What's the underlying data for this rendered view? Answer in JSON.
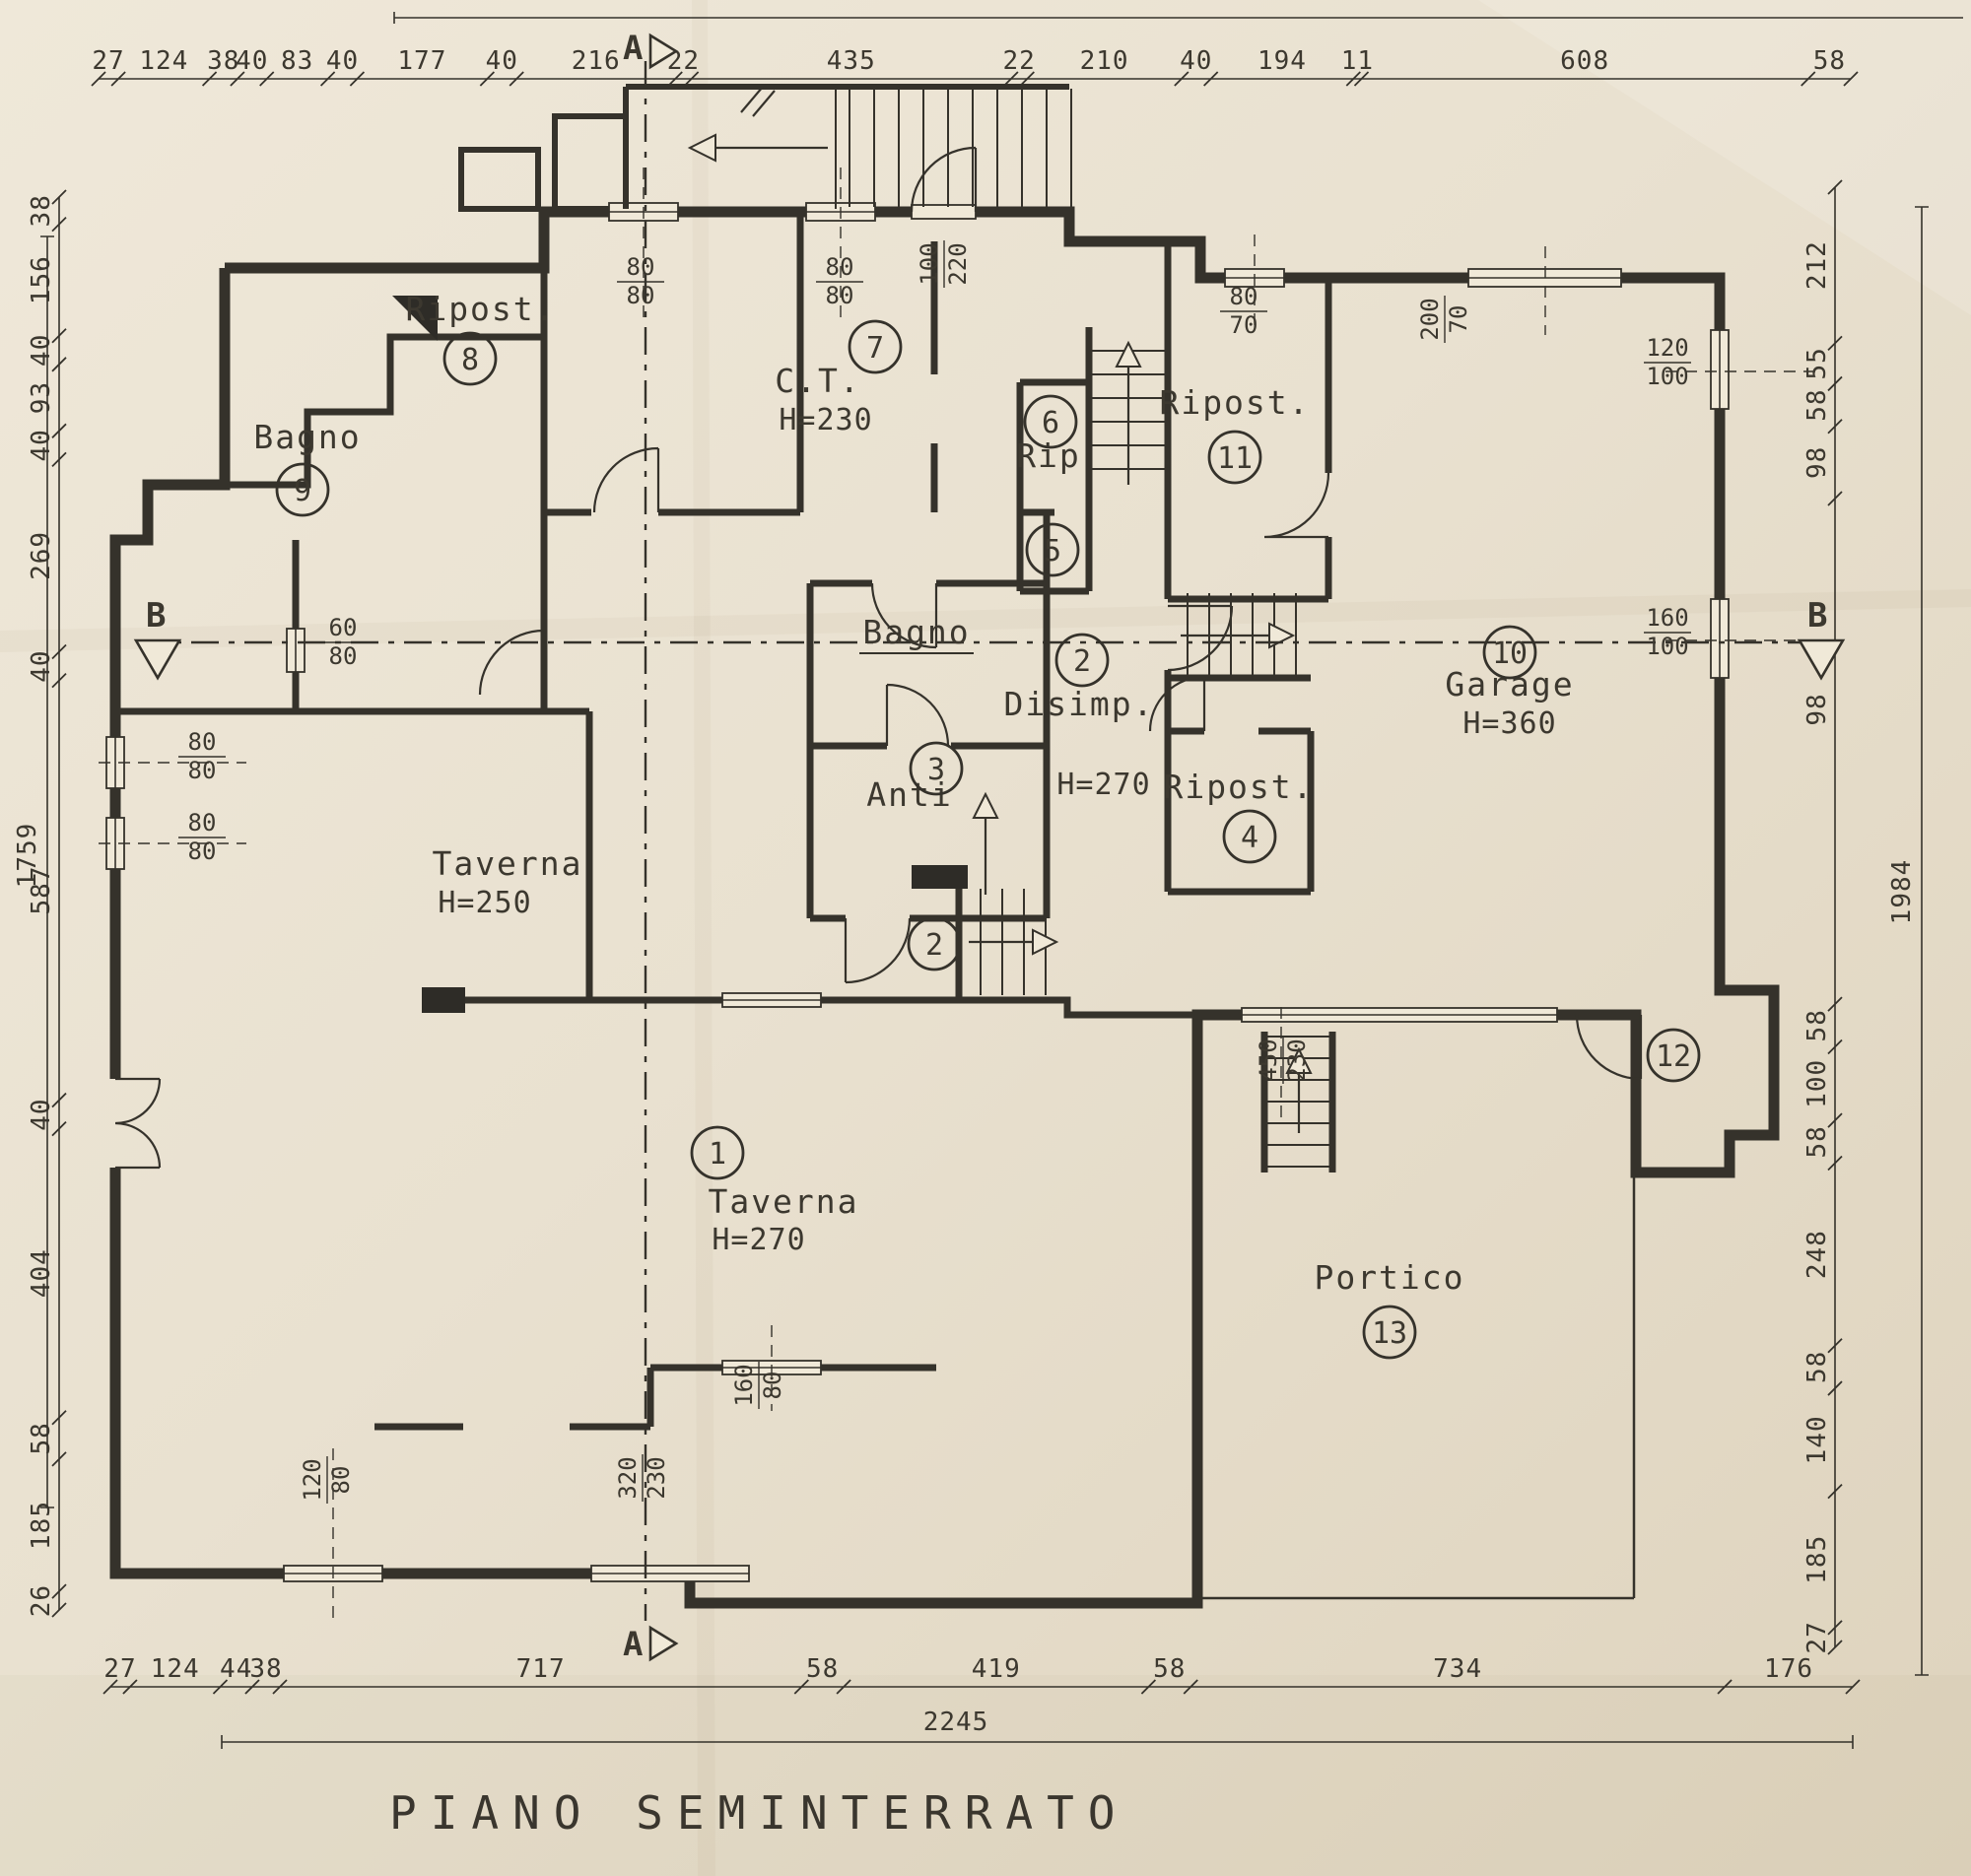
{
  "title": "PIANO SEMINTERRATO",
  "sections": {
    "a": "A",
    "b": "B"
  },
  "rooms": [
    {
      "id": "taverna-1",
      "label": "Taverna",
      "height": "H=270",
      "number": "1"
    },
    {
      "id": "taverna-250",
      "label": "Taverna",
      "height": "H=250",
      "number": ""
    },
    {
      "id": "disimp-2",
      "label": "Disimp.",
      "height": "H=270",
      "number": "2"
    },
    {
      "id": "anti-3",
      "label": "Anti",
      "height": "",
      "number": "3"
    },
    {
      "id": "ripost-4",
      "label": "Ripost.",
      "height": "",
      "number": "4"
    },
    {
      "id": "vano-5",
      "label": "",
      "height": "",
      "number": "5"
    },
    {
      "id": "rip-6",
      "label": "Rip",
      "height": "",
      "number": "6"
    },
    {
      "id": "ct-7",
      "label": "C.T.",
      "height": "H=230",
      "number": "7"
    },
    {
      "id": "ripost-8",
      "label": "Ripost.",
      "height": "",
      "number": "8"
    },
    {
      "id": "bagno-9",
      "label": "Bagno",
      "height": "",
      "number": "9"
    },
    {
      "id": "garage-10",
      "label": "Garage",
      "height": "H=360",
      "number": "10"
    },
    {
      "id": "ripost-11",
      "label": "Ripost.",
      "height": "",
      "number": "11"
    },
    {
      "id": "ingresso-12",
      "label": "",
      "height": "",
      "number": "12"
    },
    {
      "id": "portico-13",
      "label": "Portico",
      "height": "",
      "number": "13"
    },
    {
      "id": "bagno-centrale",
      "label": "Bagno",
      "height": "",
      "number": "",
      "underline": true
    },
    {
      "id": "scala-2",
      "label": "",
      "height": "",
      "number": "2"
    }
  ],
  "openings": [
    {
      "id": "ct-window-left",
      "num": "80",
      "den": "80"
    },
    {
      "id": "ct-window-right",
      "num": "80",
      "den": "80"
    },
    {
      "id": "hall-top-door",
      "num": "100",
      "den": "220"
    },
    {
      "id": "ripost11-window",
      "num": "80",
      "den": "70"
    },
    {
      "id": "garage-top-window",
      "num": "200",
      "den": "70"
    },
    {
      "id": "garage-right-window-upper",
      "num": "120",
      "den": "100"
    },
    {
      "id": "garage-right-window-lower",
      "num": "160",
      "den": "100"
    },
    {
      "id": "bagno9-window",
      "num": "60",
      "den": "80"
    },
    {
      "id": "taverna250-window-upper",
      "num": "80",
      "den": "80"
    },
    {
      "id": "taverna250-window-lower",
      "num": "80",
      "den": "80"
    },
    {
      "id": "bottom-left-window",
      "num": "120",
      "den": "80"
    },
    {
      "id": "bottom-opening",
      "num": "320",
      "den": "230"
    },
    {
      "id": "taverna-passage",
      "num": "160",
      "den": "80"
    },
    {
      "id": "garage-door",
      "num": "450",
      "den": "230"
    }
  ],
  "dimensions": {
    "top": [
      "27",
      "124",
      "38",
      "40",
      "83",
      "40",
      "177",
      "40",
      "216",
      "22",
      "435",
      "22",
      "210",
      "40",
      "194",
      "11",
      "608",
      "58"
    ],
    "bottom": [
      "27",
      "124",
      "44",
      "38",
      "717",
      "58",
      "419",
      "58",
      "734",
      "176"
    ],
    "bottom_total": "2245",
    "left": [
      "38",
      "156",
      "40",
      "93",
      "40",
      "269",
      "40",
      "587",
      "40",
      "404",
      "58",
      "185",
      "26"
    ],
    "left_total": "1759",
    "right": [
      "212",
      "55",
      "58",
      "98",
      "",
      "58",
      "100",
      "58",
      "248",
      "58",
      "140",
      "185",
      "27"
    ],
    "right_total": "1984",
    "right_section_height": "98"
  }
}
